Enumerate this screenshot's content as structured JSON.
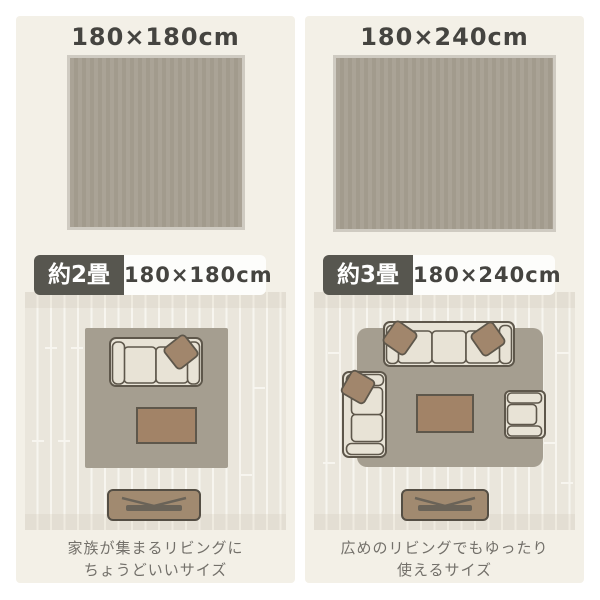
{
  "palette": {
    "page_bg": "#ffffff",
    "panel_bg": "#f3f0e7",
    "title": "#454440",
    "badge_bg": "#57564f",
    "badge_text": "#ffffff",
    "label_bg": "#fdfdfb",
    "label_text": "#454440",
    "swatch_fill": "#aaa396",
    "swatch_stripe": "#a29b8d",
    "swatch_border": "#cfcbc2",
    "floor": "#eae6dc",
    "floor_line": "#f7f5ef",
    "band": "#e3ded3",
    "band_tick": "#efebe0",
    "room_rug": "#a59e90",
    "furniture_fill": "#e8e3d6",
    "furniture_outline": "#5e574b",
    "cushion_fill": "#a1866c",
    "table_fill": "#a28367",
    "tv_fill": "#a18a70",
    "tv_outline": "#544e44",
    "tv_dark": "#6a6358",
    "caption": "#73706a"
  },
  "panels": [
    {
      "title": "180×180cm",
      "badge": "約2畳",
      "size_label": "180×180cm",
      "caption_line1": "家族が集まるリビングに",
      "caption_line2": "ちょうどいいサイズ",
      "rug_shape": "square",
      "furniture": [
        "two-seat-sofa",
        "cushion",
        "low-table",
        "tv-board"
      ]
    },
    {
      "title": "180×240cm",
      "badge": "約3畳",
      "size_label": "180×240cm",
      "caption_line1": "広めのリビングでもゆったり",
      "caption_line2": "使えるサイズ",
      "rug_shape": "landscape",
      "furniture": [
        "three-seat-sofa",
        "loveseat-sofa",
        "armchair",
        "cushions",
        "low-table",
        "tv-board"
      ]
    }
  ]
}
